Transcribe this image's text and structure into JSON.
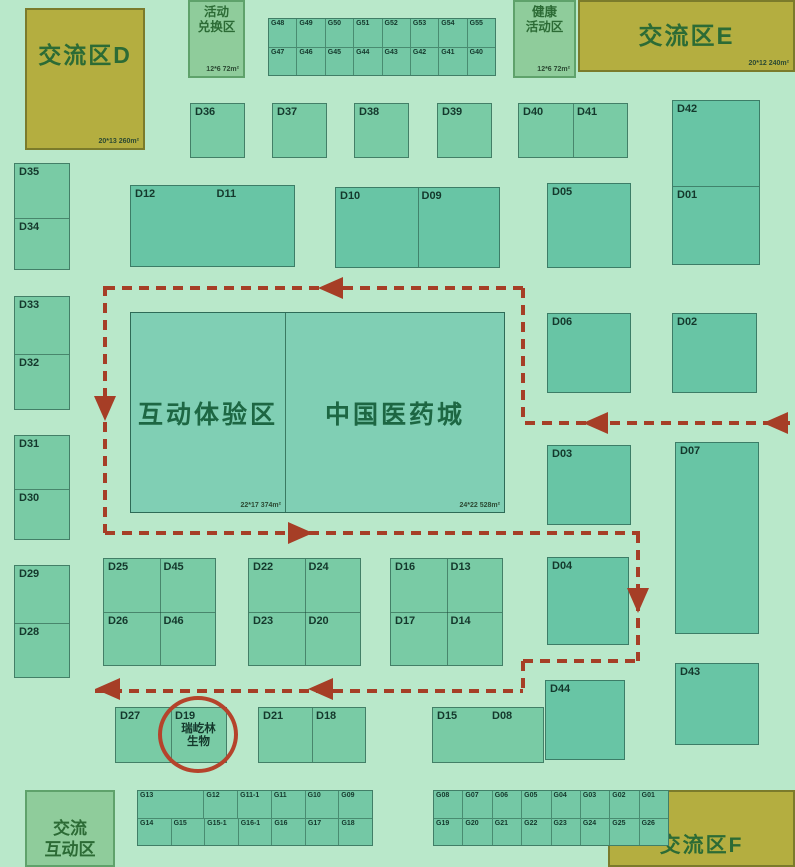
{
  "colors": {
    "background": "#b9e8ca",
    "booth_green": "#79cba5",
    "booth_teal": "#68c5a5",
    "central_green": "#80cfb4",
    "grid_green": "#74c8a5",
    "olive_area": "#b4ae40",
    "soft_green_area": "#8fcc9b",
    "route_red": "#a63e26",
    "circle_red": "#b5432b",
    "label_dark": "#14382c",
    "area_text_green": "#2c6b35"
  },
  "areas": {
    "zone_d": {
      "label": "交流区D",
      "size": "20*13 260m²"
    },
    "activity_exchange": {
      "line1": "活动",
      "line2": "兑换区",
      "size": "12*6 72m²"
    },
    "health_activity": {
      "line1": "健康",
      "line2": "活动区",
      "size": "12*6 72m²"
    },
    "zone_e": {
      "label": "交流区E",
      "size": "20*12 240m²"
    },
    "interactive_zone": {
      "label": "互动体验区",
      "size": "22*17 374m²"
    },
    "china_med_city": {
      "label": "中国医药城",
      "size": "24*22 528m²"
    },
    "exchange_interactive": {
      "line1": "交流",
      "line2": "互动区"
    },
    "zone_f": {
      "label": "交流区F"
    }
  },
  "highlight": {
    "booth": "D19",
    "company_line1": "瑞屹林",
    "company_line2": "生物"
  },
  "booths": {
    "singles": [
      "D36",
      "D37",
      "D38",
      "D39",
      "D05",
      "D06",
      "D02",
      "D03",
      "D07",
      "D04",
      "D44",
      "D43"
    ],
    "pairs_h": [
      [
        "D40",
        "D41"
      ],
      [
        "D12",
        "D11"
      ],
      [
        "D10",
        "D09"
      ],
      [
        "D21",
        "D18"
      ],
      [
        "D15",
        "D08"
      ]
    ],
    "pairs_v": [
      [
        "D35",
        "D34"
      ],
      [
        "D33",
        "D32"
      ],
      [
        "D31",
        "D30"
      ],
      [
        "D29",
        "D28"
      ],
      [
        "D42",
        "D01"
      ]
    ],
    "quads": [
      [
        [
          "D25",
          "D45"
        ],
        [
          "D26",
          "D46"
        ]
      ],
      [
        [
          "D22",
          "D24"
        ],
        [
          "D23",
          "D20"
        ]
      ],
      [
        [
          "D16",
          "D13"
        ],
        [
          "D17",
          "D14"
        ]
      ]
    ],
    "special_pair": [
      "D27",
      "D19"
    ],
    "g_top": [
      [
        "G48",
        "G49",
        "G50",
        "G51",
        "G52",
        "G53",
        "G54",
        "G55"
      ],
      [
        "G47",
        "G46",
        "G45",
        "G44",
        "G43",
        "G42",
        "G41",
        "G40"
      ]
    ],
    "g_bottom_left_top": [
      "G13",
      "G12",
      "G11-1",
      "G11",
      "G10",
      "G09"
    ],
    "g_bottom_left_bottom": [
      "G14",
      "G15",
      "G15-1",
      "G16-1",
      "G16",
      "G17",
      "G18"
    ],
    "g_bottom_right": [
      [
        "G08",
        "G07",
        "G06",
        "G05",
        "G04",
        "G03",
        "G02",
        "G01"
      ],
      [
        "G19",
        "G20",
        "G21",
        "G22",
        "G23",
        "G24",
        "G25",
        "G26"
      ]
    ]
  }
}
